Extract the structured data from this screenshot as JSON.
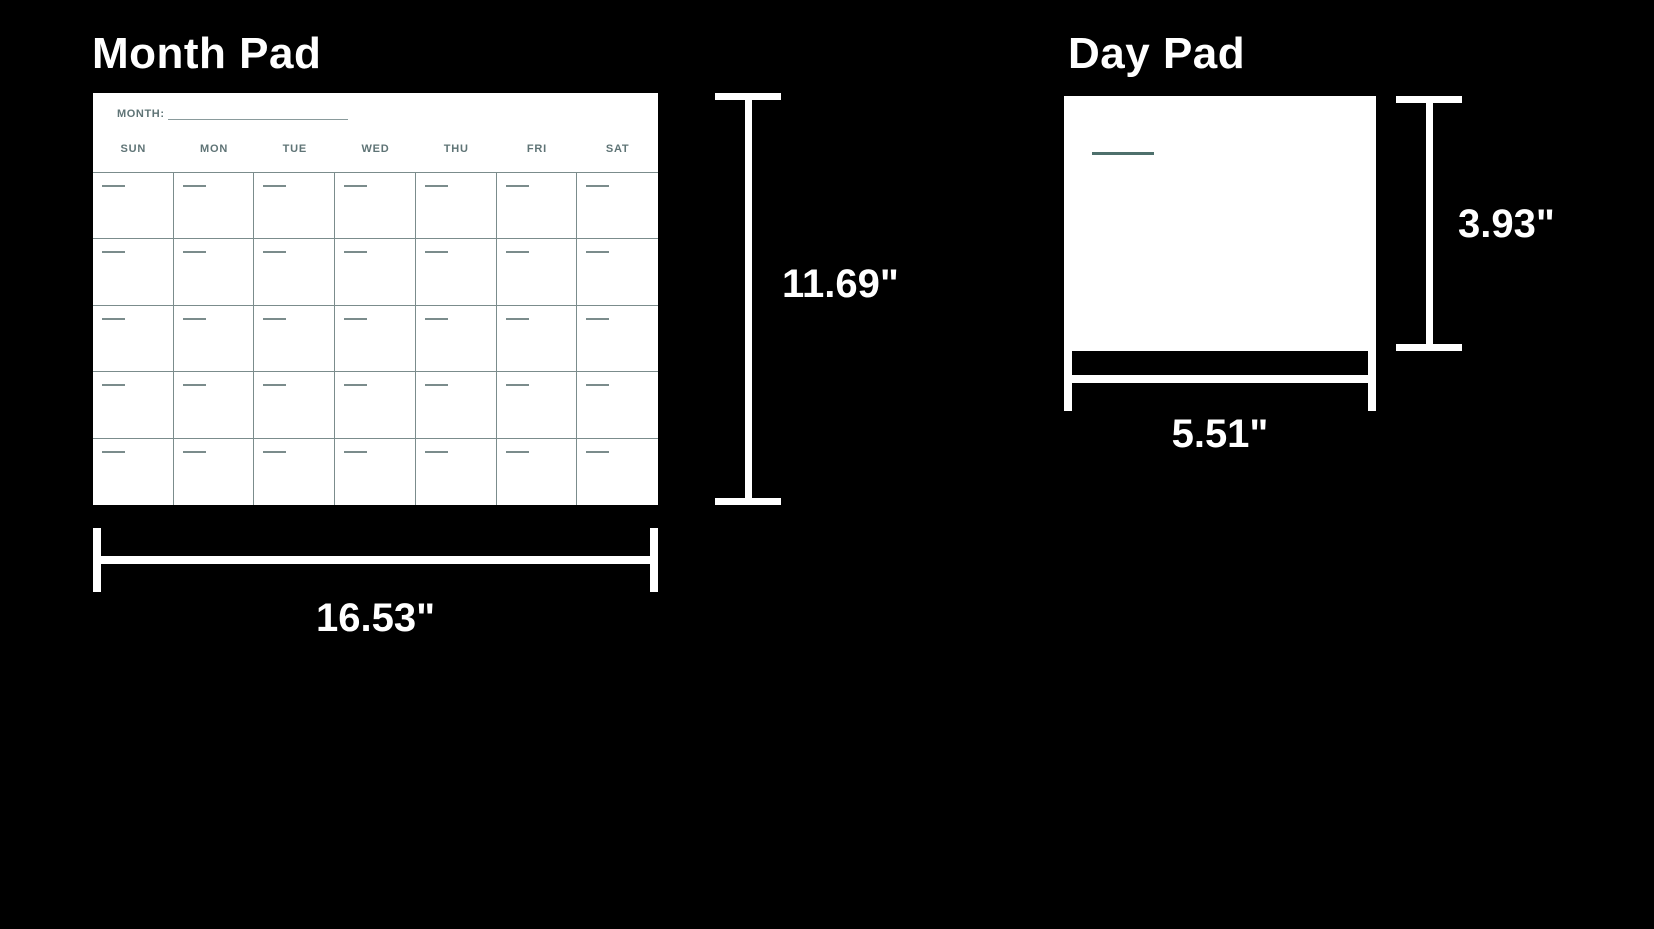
{
  "month_pad": {
    "title": "Month Pad",
    "height_label": "11.69\"",
    "width_label": "16.53\"",
    "calendar": {
      "month_field_label": "MONTH:",
      "day_headers": [
        "SUN",
        "MON",
        "TUE",
        "WED",
        "THU",
        "FRI",
        "SAT"
      ],
      "rows": 5,
      "columns": 7
    }
  },
  "day_pad": {
    "title": "Day Pad",
    "height_label": "3.93\"",
    "width_label": "5.51\""
  },
  "colors": {
    "background": "#000000",
    "card": "#ffffff",
    "dimension_lines": "#ffffff",
    "calendar_ink": "#5f7476",
    "grid_line": "#7b8c8c",
    "accent_line": "#4e706c"
  }
}
